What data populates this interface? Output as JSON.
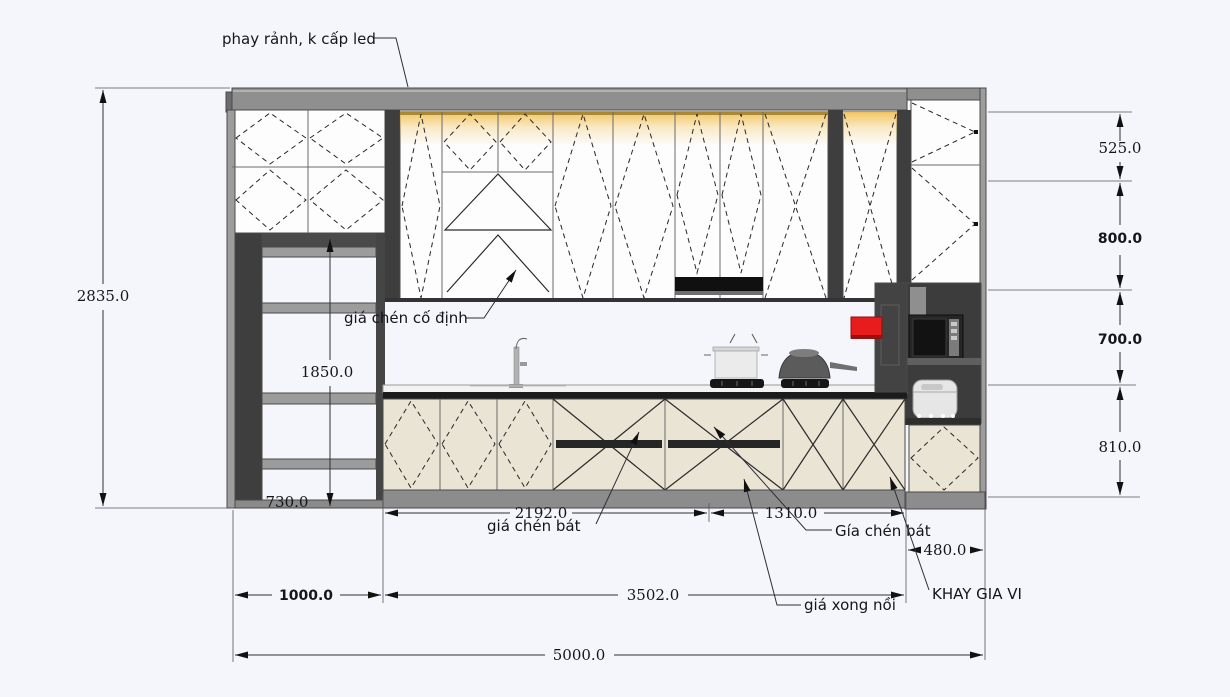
{
  "drawing": {
    "title_note": "kitchen elevation drawing",
    "labels": {
      "led_note": "phay rảnh, k cấp led",
      "fixed_dish_rack": "giá chén cố định",
      "dish_rack_lower": "giá chén bát",
      "dish_rack_right": "Gía chén bát",
      "pot_rack": "giá xong nồi",
      "spice_tray": "KHAY GIA VI"
    },
    "dimensions": {
      "total_height": "2835.0",
      "open_shelf_height": "1850.0",
      "open_shelf_width": "730.0",
      "upper_top_height": "525.0",
      "upper_cabinet_height": "800.0",
      "backsplash_height": "700.0",
      "base_cabinet_height": "810.0",
      "counter_left_width": "2192.0",
      "counter_right_width": "1310.0",
      "tall_unit_width": "480.0",
      "left_unit_width": "1000.0",
      "base_run_width": "3502.0",
      "total_width": "5000.0"
    },
    "colors": {
      "background": "#f5f5fc",
      "crown_gray": "#8f8f8f",
      "carcass_dark": "#3e3e3e",
      "door_white": "#fdfdfe",
      "door_beige": "#eae4d4",
      "plinth_gray": "#8c8c8c",
      "counter_black": "#1b1b1b",
      "led_glow": "#f2c35a",
      "red_board": "#e81c1c"
    }
  }
}
